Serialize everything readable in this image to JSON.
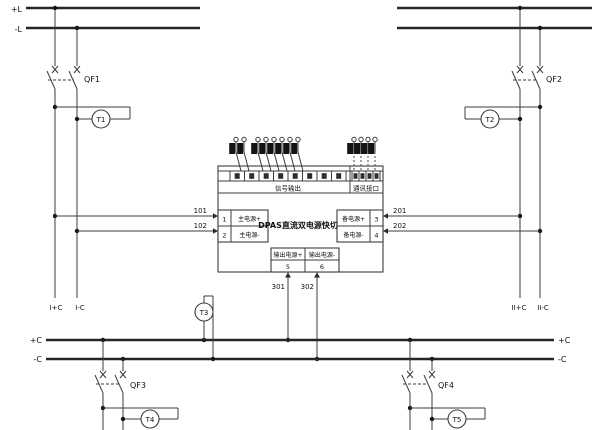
{
  "top_left_bus": {
    "pos": "+L",
    "neg": "-L"
  },
  "bottom_bus": {
    "left_pos": "+C",
    "left_neg": "-C",
    "right_pos": "+C",
    "right_neg": "-C"
  },
  "breakers": {
    "qf1": "QF1",
    "qf2": "QF2",
    "qf3": "QF3",
    "qf4": "QF4"
  },
  "meters": {
    "t1": "T1",
    "t2": "T2",
    "t3": "T3",
    "t4": "T4",
    "t5": "T5"
  },
  "wire_numbers": {
    "n101": "101",
    "n102": "102",
    "n201": "201",
    "n202": "202",
    "n301": "301",
    "n302": "302"
  },
  "feeders": {
    "left_pos": "I+C",
    "left_neg": "I-C",
    "right_pos": "II+C",
    "right_neg": "II-C"
  },
  "module": {
    "title": "DPAS直流双电源快切",
    "signal_label": "信号输出",
    "comm_label": "通讯接口",
    "terminals": {
      "t1_no": "1",
      "t1_label": "主电源+",
      "t2_no": "2",
      "t2_label": "主电源-",
      "t3_no": "3",
      "t3_label": "备电源+",
      "t4_no": "4",
      "t4_label": "备电源-",
      "t5_no": "5",
      "t5_label": "输出电源+",
      "t6_no": "6",
      "t6_label": "输出电源-"
    }
  },
  "colors": {
    "line": "#3c3c3c",
    "background": "#ffffff"
  }
}
